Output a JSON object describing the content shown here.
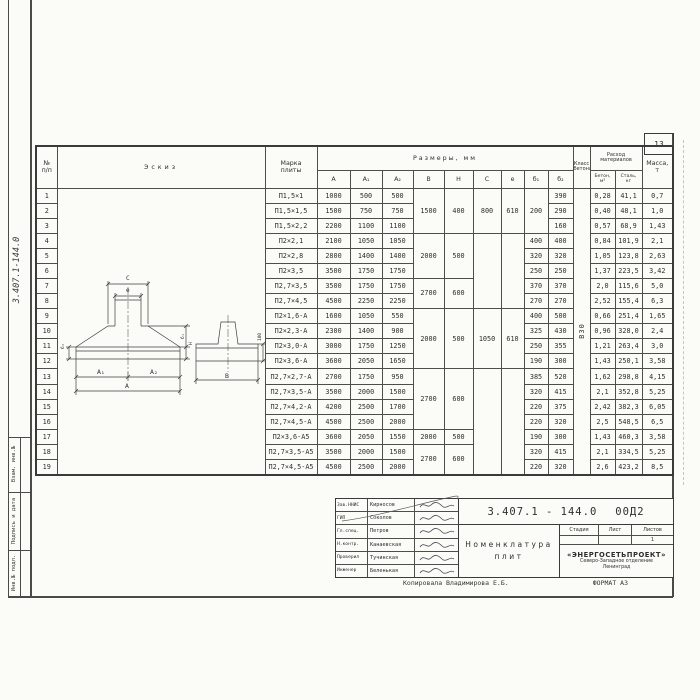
{
  "page": {
    "sheet_no": "13",
    "copied": "Копировала  Владимирова Е.Б.",
    "format": "ФОРМАТ А3"
  },
  "margin": {
    "side_number": "3.407.1-144.0",
    "labels": [
      "Взам. инв.№",
      "Подпись и дата",
      "Инв.№ подл."
    ]
  },
  "sketch": {
    "dim_c": "С",
    "dim_e": "е",
    "dim_a1": "А₁",
    "dim_a2": "А₂",
    "dim_a": "А",
    "dim_b": "В",
    "dim_b1": "б₁",
    "dim_b2": "б₂",
    "dim_h": "Н",
    "dim_100": "100"
  },
  "table": {
    "headers": {
      "num": "№",
      "num_sub": "п/п",
      "sketch": "Эскиз",
      "marka_1": "Марка",
      "marka_2": "плиты",
      "sizes": "Размеры,  мм",
      "size_cols": [
        "А",
        "А₁",
        "А₂",
        "В",
        "Н",
        "С",
        "е",
        "б₁",
        "б₂"
      ],
      "class_1": "Класс",
      "class_2": "бетона",
      "consumption_1": "Расход",
      "consumption_2": "материалов",
      "beton_1": "Бетон,",
      "beton_2": "м³",
      "steel_1": "Сталь,",
      "steel_2": "кг",
      "mass_1": "Масса,",
      "mass_2": "т"
    },
    "merges": {
      "bh": [
        {
          "start": 0,
          "span": 3,
          "b": "1500",
          "h": "400"
        },
        {
          "start": 3,
          "span": 3,
          "b": "2000",
          "h": "500"
        },
        {
          "start": 6,
          "span": 2,
          "b": "2700",
          "h": "600"
        },
        {
          "start": 8,
          "span": 4,
          "b": "2000",
          "h": "500"
        },
        {
          "start": 12,
          "span": 4,
          "b": "2700",
          "h": "600"
        },
        {
          "start": 16,
          "span": 1,
          "b": "2000",
          "h": "500"
        },
        {
          "start": 17,
          "span": 2,
          "b": "2700",
          "h": "600"
        }
      ],
      "c": [
        {
          "start": 0,
          "span": 3,
          "v": "800"
        },
        {
          "start": 3,
          "span": 5,
          "v": ""
        },
        {
          "start": 8,
          "span": 4,
          "v": "1050"
        },
        {
          "start": 12,
          "span": 7,
          "v": ""
        }
      ],
      "e": [
        {
          "start": 0,
          "span": 3,
          "v": "610"
        },
        {
          "start": 3,
          "span": 5,
          "v": ""
        },
        {
          "start": 8,
          "span": 4,
          "v": "610"
        },
        {
          "start": 12,
          "span": 7,
          "v": ""
        }
      ],
      "b1": [
        {
          "start": 0,
          "span": 3,
          "v": "200"
        }
      ],
      "cls": {
        "v": "В30"
      }
    },
    "rows": [
      {
        "num": "1",
        "marka": "П1,5×1",
        "a": "1000",
        "a1": "500",
        "a2": "500",
        "b2": "390",
        "beton": "0,28",
        "steel": "41,1",
        "mass": "0,7"
      },
      {
        "num": "2",
        "marka": "П1,5×1,5",
        "a": "1500",
        "a1": "750",
        "a2": "750",
        "b2": "290",
        "beton": "0,40",
        "steel": "48,1",
        "mass": "1,0"
      },
      {
        "num": "3",
        "marka": "П1,5×2,2",
        "a": "2200",
        "a1": "1100",
        "a2": "1100",
        "b2": "160",
        "beton": "0,57",
        "steel": "68,9",
        "mass": "1,43"
      },
      {
        "num": "4",
        "marka": "П2×2,1",
        "a": "2100",
        "a1": "1050",
        "a2": "1050",
        "b1": "400",
        "b2": "400",
        "beton": "0,84",
        "steel": "101,9",
        "mass": "2,1"
      },
      {
        "num": "5",
        "marka": "П2×2,8",
        "a": "2800",
        "a1": "1400",
        "a2": "1400",
        "b1": "320",
        "b2": "320",
        "beton": "1,05",
        "steel": "123,8",
        "mass": "2,63"
      },
      {
        "num": "6",
        "marka": "П2×3,5",
        "a": "3500",
        "a1": "1750",
        "a2": "1750",
        "b1": "250",
        "b2": "250",
        "beton": "1,37",
        "steel": "223,5",
        "mass": "3,42"
      },
      {
        "num": "7",
        "marka": "П2,7×3,5",
        "a": "3500",
        "a1": "1750",
        "a2": "1750",
        "b1": "370",
        "b2": "370",
        "beton": "2,0",
        "steel": "115,6",
        "mass": "5,0"
      },
      {
        "num": "8",
        "marka": "П2,7×4,5",
        "a": "4500",
        "a1": "2250",
        "a2": "2250",
        "b1": "270",
        "b2": "270",
        "beton": "2,52",
        "steel": "155,4",
        "mass": "6,3"
      },
      {
        "num": "9",
        "marka": "П2×1,6-А",
        "a": "1600",
        "a1": "1050",
        "a2": "550",
        "b1": "400",
        "b2": "500",
        "beton": "0,66",
        "steel": "251,4",
        "mass": "1,65"
      },
      {
        "num": "10",
        "marka": "П2×2,3-А",
        "a": "2300",
        "a1": "1400",
        "a2": "900",
        "b1": "325",
        "b2": "430",
        "beton": "0,96",
        "steel": "328,0",
        "mass": "2,4"
      },
      {
        "num": "11",
        "marka": "П2×3,0-А",
        "a": "3000",
        "a1": "1750",
        "a2": "1250",
        "b1": "250",
        "b2": "355",
        "beton": "1,21",
        "steel": "263,4",
        "mass": "3,0"
      },
      {
        "num": "12",
        "marka": "П2×3,6-А",
        "a": "3600",
        "a1": "2050",
        "a2": "1650",
        "b1": "190",
        "b2": "300",
        "beton": "1,43",
        "steel": "250,1",
        "mass": "3,58"
      },
      {
        "num": "13",
        "marka": "П2,7×2,7-А",
        "a": "2700",
        "a1": "1750",
        "a2": "950",
        "b1": "385",
        "b2": "520",
        "beton": "1,62",
        "steel": "298,8",
        "mass": "4,15"
      },
      {
        "num": "14",
        "marka": "П2,7×3,5-А",
        "a": "3500",
        "a1": "2000",
        "a2": "1500",
        "b1": "320",
        "b2": "415",
        "beton": "2,1",
        "steel": "352,8",
        "mass": "5,25"
      },
      {
        "num": "15",
        "marka": "П2,7×4,2-А",
        "a": "4200",
        "a1": "2500",
        "a2": "1700",
        "b1": "220",
        "b2": "375",
        "beton": "2,42",
        "steel": "382,3",
        "mass": "6,05"
      },
      {
        "num": "16",
        "marka": "П2,7×4,5-А",
        "a": "4500",
        "a1": "2500",
        "a2": "2000",
        "b1": "220",
        "b2": "320",
        "beton": "2,5",
        "steel": "548,5",
        "mass": "6,5"
      },
      {
        "num": "17",
        "marka": "П2×3,6-А5",
        "a": "3600",
        "a1": "2050",
        "a2": "1550",
        "b1": "190",
        "b2": "300",
        "beton": "1,43",
        "steel": "460,3",
        "mass": "3,58"
      },
      {
        "num": "18",
        "marka": "П2,7×3,5-А5",
        "a": "3500",
        "a1": "2000",
        "a2": "1500",
        "b1": "320",
        "b2": "415",
        "beton": "2,1",
        "steel": "334,5",
        "mass": "5,25"
      },
      {
        "num": "19",
        "marka": "П2,7×4,5-А5",
        "a": "4500",
        "a1": "2500",
        "a2": "2000",
        "b1": "220",
        "b2": "320",
        "beton": "2,6",
        "steel": "423,2",
        "mass": "8,5"
      }
    ]
  },
  "title_block": {
    "doc_number": "3.407.1 - 144.0",
    "doc_suffix": "00Д2",
    "title_line1": "Номенклатура",
    "title_line2": "плит",
    "stage_label": "Стадия",
    "sheet_label": "Лист",
    "sheets_label": "Листов",
    "sheets_value": "1",
    "org_name": "«ЭНЕРГОСЕТЬПРОЕКТ»",
    "org_line2": "Северо-Западное отделение",
    "org_line3": "Ленинград",
    "people": [
      {
        "role": "Зав.ННИС",
        "name": "Кирносов"
      },
      {
        "role": "ГИП",
        "name": "Соколов"
      },
      {
        "role": "Гл.спец.",
        "name": "Петров"
      },
      {
        "role": "Н.контр.",
        "name": "Канаевская"
      },
      {
        "role": "Проверил",
        "name": "Тучинская"
      },
      {
        "role": "Инженер",
        "name": "Беленькая"
      }
    ]
  }
}
